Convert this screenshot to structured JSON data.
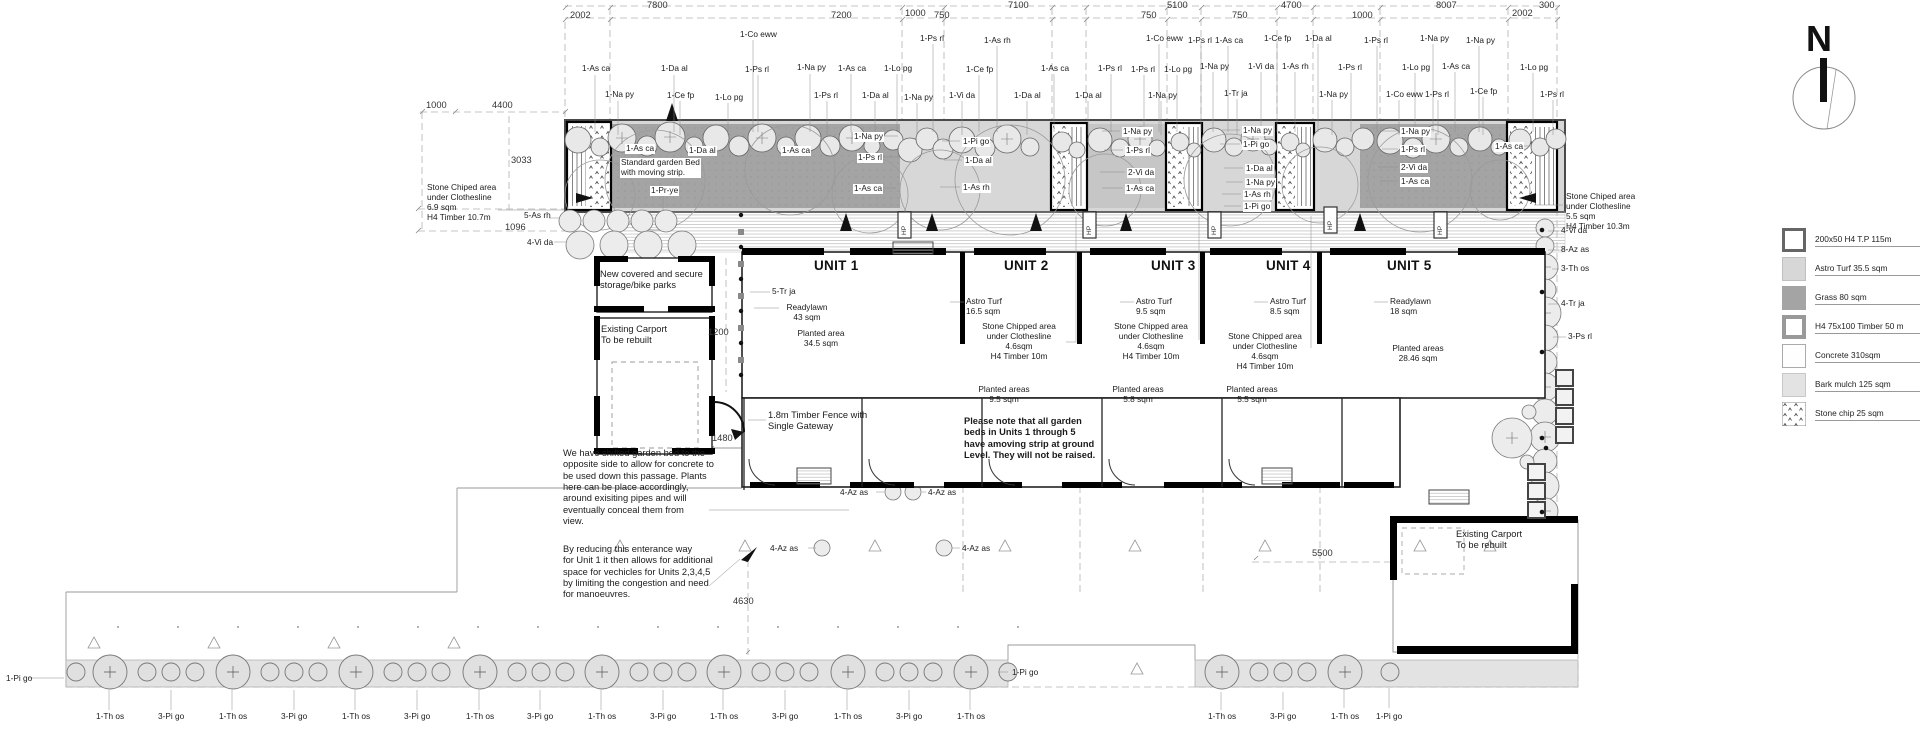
{
  "north_label": "N",
  "dims_top": [
    "2002",
    "7800",
    "7200",
    "1000",
    "750",
    "7100",
    "750",
    "5100",
    "750",
    "4700",
    "1000",
    "8007",
    "2002",
    "300"
  ],
  "dims_left": [
    "1000",
    "4400",
    "3033",
    "1096"
  ],
  "dims_other": [
    "1200",
    "1480",
    "4630",
    "5500"
  ],
  "plants_top": [
    "1-Co eww",
    "1-Ps rl",
    "1-As rh",
    "1-Co eww",
    "1-Ps rl",
    "1-As ca",
    "1-Ce fp",
    "1-Da al",
    "1-Ps rl",
    "1-Na py",
    "1-Na py",
    "1-As ca",
    "1-Da al",
    "1-Ps rl",
    "1-Na py",
    "1-As ca",
    "1-Lo pg",
    "1-Ce fp",
    "1-As ca",
    "1-Ps rl",
    "1-Ps rl",
    "1-Lo pg",
    "1-Na py",
    "1-Vi da",
    "1-As rh",
    "1-Ps rl",
    "1-Lo pg",
    "1-As ca",
    "1-Lo pg",
    "1-Na py",
    "1-Ce fp",
    "1-Lo pg",
    "1-Ps rl",
    "1-Da al",
    "1-Na py",
    "1-Vi da",
    "1-Da al",
    "1-Da al",
    "1-Na py",
    "1-Tr ja",
    "1-Na py",
    "1-Co eww",
    "1-Ps rl",
    "1-Ce fp",
    "1-Ps rl"
  ],
  "plants_bed": [
    "1-As ca",
    "1-Da al",
    "1-As ca",
    "1-Pr-ye",
    "1-Na py",
    "1-Ps rl",
    "1-As ca",
    "1-Pi go",
    "1-Da al",
    "1-As rh",
    "1-Na py",
    "1-Ps rl",
    "2-Vi da",
    "1-As ca",
    "1-Na py",
    "1-Pi go",
    "1-Da al",
    "1-Na py",
    "1-As rh",
    "1-Pi go",
    "1-Na py",
    "1-Ps rl",
    "2-Vi da",
    "1-As ca",
    "1-As ca"
  ],
  "plants_bottom": [
    "1-Pi go",
    "1-Th os",
    "3-Pi go",
    "1-Th os",
    "3-Pi go",
    "1-Th os",
    "3-Pi go",
    "1-Th os",
    "3-Pi go",
    "1-Th os",
    "3-Pi go",
    "1-Th os",
    "3-Pi go",
    "1-Th os",
    "3-Pi go",
    "1-Th os",
    "1-Pi go",
    "1-Th os",
    "3-Pi go",
    "1-Th os",
    "1-Pi go"
  ],
  "plants_right": [
    "4-Vi da",
    "8-Az as",
    "3-Th os",
    "4-Tr ja",
    "3-Ps rl"
  ],
  "plants_side": {
    "as_rh": "5-As rh",
    "vi_da": "4-Vi da",
    "az_as": "4-Az as"
  },
  "units": [
    {
      "name": "UNIT 1",
      "plant": "5-Tr ja",
      "lawn": "Readylawn\n43 sqm",
      "planted": "Planted area\n34.5 sqm"
    },
    {
      "name": "UNIT 2",
      "turf": "Astro Turf\n16.5 sqm",
      "clothesline": "Stone Chipped area\nunder Clothesline\n4.6sqm\nH4 Timber 10m",
      "planted": "Planted areas\n9.5 sqm"
    },
    {
      "name": "UNIT 3",
      "turf": "Astro Turf\n9.5 sqm",
      "clothesline": "Stone Chipped area\nunder Clothesline\n4.6sqm\nH4 Timber 10m",
      "planted": "Planted areas\n5.8 sqm"
    },
    {
      "name": "UNIT 4",
      "turf": "Astro Turf\n8.5 sqm",
      "clothesline": "Stone Chipped area\nunder Clothesline\n4.6sqm\nH4 Timber 10m",
      "planted": "Planted areas\n5.5 sqm"
    },
    {
      "name": "UNIT 5",
      "lawn": "Readylawn\n18 sqm",
      "planted": "Planted areas\n28.46 sqm"
    }
  ],
  "annotations": {
    "clothesline_left": "Stone Chiped area\nunder Clothesline\n6.9 sqm\nH4 Timber 10.7m",
    "clothesline_right": "Stone Chiped area\nunder Clothesline\n5.5 sqm\nH4 Timber 10.3m",
    "standard_bed": "Standard garden Bed\nwith moving strip.",
    "storage": "New covered and secure\nstorage/bike parks",
    "carport_left": "Existing Carport\nTo be rebuilt",
    "carport_right": "Existing Carport\nTo be rebuilt",
    "fence": "1.8m Timber Fence with\nSingle Gateway",
    "note_shifted": "We have shifted garden bed to the\nopposite side to allow for concrete to\nbe used down this passage. Plants\nhere can be place accordingly,\naround exisiting pipes and will\neventually conceal them from\nview.",
    "note_entrance": "By reducing this enterance way\nfor Unit 1 it then allows for additional\nspace for vechicles for Units 2,3,4,5\nby limiting the congestion and need\nfor manoeuvres.",
    "note_beds": "Please note that all garden\nbeds in Units 1 through 5\nhave amoving strip at ground\nLevel. They will not be raised.",
    "hp": "HP"
  },
  "legend": {
    "items": [
      {
        "label": "200x50 H4 T.P 115m"
      },
      {
        "label": "Astro Turf 35.5 sqm"
      },
      {
        "label": "Grass 80 sqm"
      },
      {
        "label": "H4 75x100 Timber 50 m"
      },
      {
        "label": "Concrete 310sqm"
      },
      {
        "label": "Bark mulch 125 sqm"
      },
      {
        "label": "Stone chip 25 sqm"
      }
    ]
  },
  "colors": {
    "grass": "#a4a4a4",
    "astro": "#d7d7d7",
    "bark": "#e3e3e3",
    "wall": "#000000",
    "line": "#999999"
  }
}
